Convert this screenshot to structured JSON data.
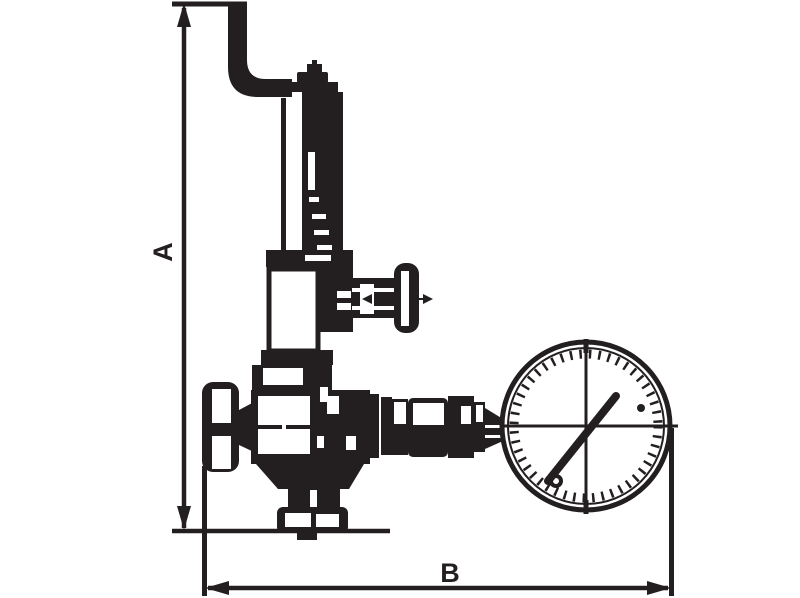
{
  "drawing": {
    "type": "technical-dimension-drawing",
    "description": "Line drawing of a spring-loaded pressure reducing valve with relief pipe and pressure gauge, annotated with overall height and width dimensions"
  },
  "labels": {
    "dim_vertical": "A",
    "dim_horizontal": "B"
  },
  "colors": {
    "ink": "#231f20",
    "background": "#ffffff"
  },
  "components": {
    "relief_pipe": "bent blow-off relief pipe",
    "adjustment_cap": "adjusting screw cap",
    "spring_housing": "spring bonnet housing",
    "bonnet": "lower bonnet chamber",
    "side_valve": "side shut-off valve with T-handle",
    "valve_body": "valve body",
    "inlet": "inlet connection nut",
    "outlet": "bottom outlet connection nut",
    "gauge_fittings": "gauge connection fittings",
    "pressure_gauge": "pressure gauge dial with needle"
  }
}
